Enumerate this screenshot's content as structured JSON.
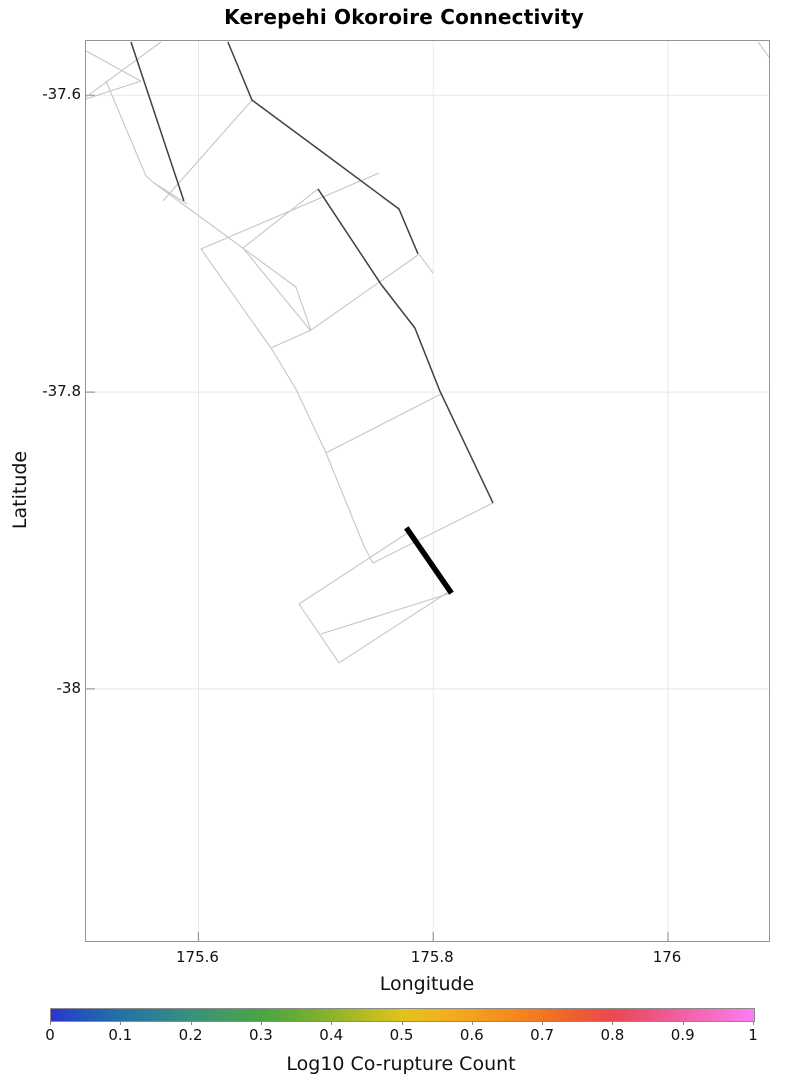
{
  "title": "Kerepehi Okoroire Connectivity",
  "chart_data": {
    "type": "map",
    "title": "Kerepehi Okoroire Connectivity",
    "xlabel": "Longitude",
    "ylabel": "Latitude",
    "xlim": [
      175.5042,
      176.086
    ],
    "ylim": [
      -38.1699,
      -37.5634
    ],
    "grid": true,
    "grid_color": "#e8e8e8",
    "border_color": "#949494",
    "tick_color": "#999999",
    "x_ticks": [
      {
        "value": 175.6,
        "label": "175.6"
      },
      {
        "value": 175.8,
        "label": "175.8"
      },
      {
        "value": 176.0,
        "label": "176"
      }
    ],
    "y_ticks": [
      {
        "value": -37.6,
        "label": "-37.6"
      },
      {
        "value": -37.8,
        "label": "-37.8"
      },
      {
        "value": -38.0,
        "label": "-38"
      }
    ],
    "fault_network": {
      "light_color": "#c6c6c6",
      "dark_color": "#404040",
      "highlight_color": "#000000",
      "light_width": 1.1,
      "dark_width": 1.5,
      "highlight_width": 5.5,
      "light_traces": [
        [
          [
            175.5042,
            -37.5701
          ],
          [
            175.551,
            -37.5904
          ]
        ],
        [
          [
            175.568,
            -37.5641
          ],
          [
            175.5042,
            -37.6011
          ]
        ],
        [
          [
            175.551,
            -37.5904
          ],
          [
            175.5042,
            -37.6025
          ]
        ],
        [
          [
            175.5212,
            -37.5904
          ],
          [
            175.5553,
            -37.6544
          ],
          [
            175.5621,
            -37.6591
          ],
          [
            175.5902,
            -37.6732
          ]
        ],
        [
          [
            175.5621,
            -37.6591
          ],
          [
            175.683,
            -37.7292
          ],
          [
            175.6958,
            -37.7582
          ]
        ],
        [
          [
            175.5697,
            -37.6712
          ],
          [
            175.6456,
            -37.6032
          ]
        ],
        [
          [
            175.6021,
            -37.7036
          ],
          [
            175.7537,
            -37.6524
          ]
        ],
        [
          [
            175.6379,
            -37.7029
          ],
          [
            175.7018,
            -37.6631
          ]
        ],
        [
          [
            175.6021,
            -37.7036
          ],
          [
            175.6618,
            -37.7703
          ],
          [
            175.683,
            -37.7979
          ],
          [
            175.7086,
            -37.841
          ],
          [
            175.741,
            -37.9037
          ],
          [
            175.7486,
            -37.9152
          ]
        ],
        [
          [
            175.6379,
            -37.7029
          ],
          [
            175.6958,
            -37.7588
          ]
        ],
        [
          [
            175.6618,
            -37.7703
          ],
          [
            175.6958,
            -37.7582
          ]
        ],
        [
          [
            175.6958,
            -37.7582
          ],
          [
            175.787,
            -37.7076
          ]
        ],
        [
          [
            175.7086,
            -37.841
          ],
          [
            175.8066,
            -37.8013
          ]
        ],
        [
          [
            175.7486,
            -37.9152
          ],
          [
            175.8509,
            -37.8747
          ]
        ],
        [
          [
            175.6856,
            -37.9428
          ],
          [
            175.7793,
            -37.8943
          ]
        ],
        [
          [
            175.6856,
            -37.9428
          ],
          [
            175.7197,
            -37.9825
          ]
        ],
        [
          [
            175.7197,
            -37.9825
          ],
          [
            175.8142,
            -37.934
          ]
        ],
        [
          [
            175.7043,
            -37.963
          ],
          [
            175.8151,
            -37.9354
          ]
        ],
        [
          [
            176.0766,
            -37.5641
          ],
          [
            176.086,
            -37.5742
          ]
        ],
        [
          [
            175.7878,
            -37.7069
          ],
          [
            175.7998,
            -37.7197
          ]
        ]
      ],
      "dark_traces": [
        [
          [
            175.5425,
            -37.5641
          ],
          [
            175.5876,
            -37.6712
          ]
        ],
        [
          [
            175.6251,
            -37.5641
          ],
          [
            175.6456,
            -37.6032
          ],
          [
            175.7043,
            -37.6375
          ],
          [
            175.7708,
            -37.6766
          ],
          [
            175.787,
            -37.7069
          ]
        ],
        [
          [
            175.7018,
            -37.6631
          ],
          [
            175.7554,
            -37.7272
          ],
          [
            175.7844,
            -37.7568
          ],
          [
            175.8057,
            -37.7993
          ],
          [
            175.8509,
            -37.8747
          ]
        ]
      ],
      "highlight_traces": [
        [
          [
            175.7784,
            -37.893
          ],
          [
            175.8142,
            -37.934
          ]
        ]
      ]
    },
    "colorbar": {
      "label": "Log10 Co-rupture Count",
      "min": 0,
      "max": 1,
      "ticks": [
        "0",
        "0.1",
        "0.2",
        "0.3",
        "0.4",
        "0.5",
        "0.6",
        "0.7",
        "0.8",
        "0.9",
        "1"
      ],
      "gradient": [
        [
          0.0,
          "#2a35d0"
        ],
        [
          0.05,
          "#2457bb"
        ],
        [
          0.1,
          "#2572a7"
        ],
        [
          0.15,
          "#2d8292"
        ],
        [
          0.2,
          "#38917b"
        ],
        [
          0.25,
          "#429c60"
        ],
        [
          0.3,
          "#48a544"
        ],
        [
          0.35,
          "#68ac33"
        ],
        [
          0.4,
          "#8db42a"
        ],
        [
          0.45,
          "#b7bc23"
        ],
        [
          0.5,
          "#e2c31d"
        ],
        [
          0.55,
          "#eeb51d"
        ],
        [
          0.6,
          "#f4a01d"
        ],
        [
          0.65,
          "#f58c1e"
        ],
        [
          0.7,
          "#f3761f"
        ],
        [
          0.75,
          "#ef5c31"
        ],
        [
          0.8,
          "#e94a52"
        ],
        [
          0.85,
          "#ed527e"
        ],
        [
          0.9,
          "#f260a6"
        ],
        [
          0.95,
          "#f76ecb"
        ],
        [
          1.0,
          "#fb7df1"
        ]
      ]
    }
  }
}
